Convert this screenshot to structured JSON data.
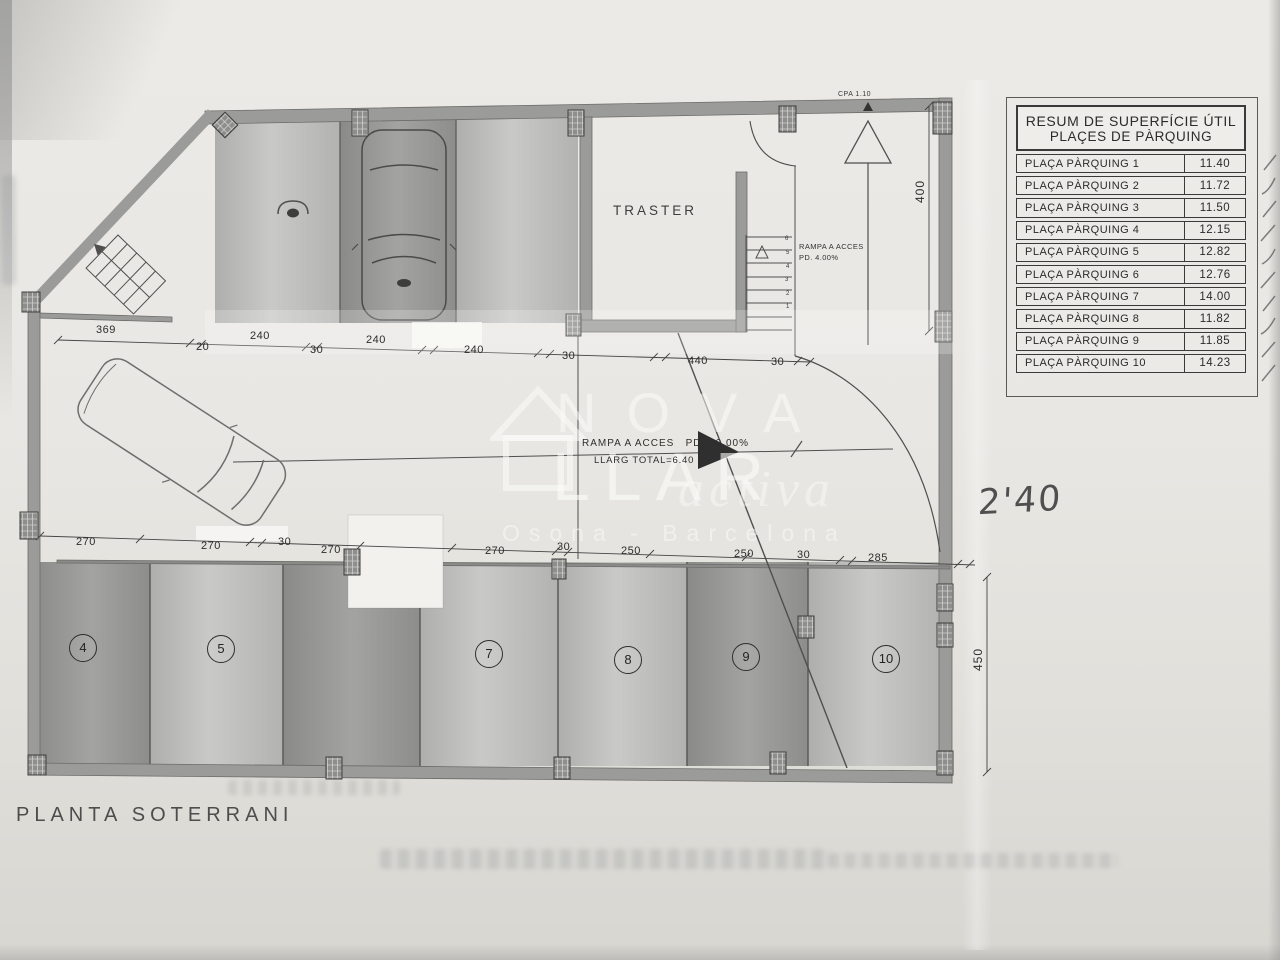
{
  "sheet": {
    "plan_title": "PLANTA SOTERRANI",
    "handwritten_note": "2'40"
  },
  "table": {
    "title_line1": "RESUM DE SUPERFÍCIE ÚTIL",
    "title_line2": "PLAÇES DE PÀRQUING",
    "rows": [
      {
        "label": "PLAÇA PÀRQUING 1",
        "value": "11.40"
      },
      {
        "label": "PLAÇA PÀRQUING 2",
        "value": "11.72"
      },
      {
        "label": "PLAÇA PÀRQUING 3",
        "value": "11.50"
      },
      {
        "label": "PLAÇA PÀRQUING 4",
        "value": "12.15"
      },
      {
        "label": "PLAÇA PÀRQUING 5",
        "value": "12.82"
      },
      {
        "label": "PLAÇA PÀRQUING 6",
        "value": "12.76"
      },
      {
        "label": "PLAÇA PÀRQUING 7",
        "value": "14.00"
      },
      {
        "label": "PLAÇA PÀRQUING 8",
        "value": "11.82"
      },
      {
        "label": "PLAÇA PÀRQUING 9",
        "value": "11.85"
      },
      {
        "label": "PLAÇA PÀRQUING 10",
        "value": "14.23"
      }
    ]
  },
  "plan": {
    "room_label": "TRASTER",
    "cpa_label": "CPA 1.10",
    "ramp_access": {
      "line1": "RAMPA A ACCES",
      "line2": "PD. 4.00%"
    },
    "ramp_main": {
      "line1": "RAMPA A ACCES   PD. 20.00%",
      "line2": "LLARG TOTAL=6.40 m."
    },
    "parking_space_numbers": [
      "4",
      "5",
      "7",
      "8",
      "9",
      "10"
    ],
    "stair_step_numbers": [
      "6",
      "5",
      "4",
      "3",
      "2",
      "1"
    ],
    "dims_top": [
      "369",
      "20",
      "240",
      "30",
      "240",
      "240",
      "30",
      "440",
      "30"
    ],
    "dims_bottom": [
      "270",
      "270",
      "30",
      "270",
      "270",
      "30",
      "250",
      "250",
      "30",
      "285"
    ],
    "dim_right_top": "400",
    "dim_right_bottom": "450"
  },
  "watermark": {
    "line1": "NOVA",
    "line2": "LLAR",
    "line3": "activa",
    "line4": "Osona - Barcelona"
  },
  "colors": {
    "paper": "#e8e7e3",
    "wall": "#9b9b99",
    "line": "#4f4f4f",
    "bay_dark": "#8f8f8d",
    "bay_light": "#c2c2c0"
  }
}
